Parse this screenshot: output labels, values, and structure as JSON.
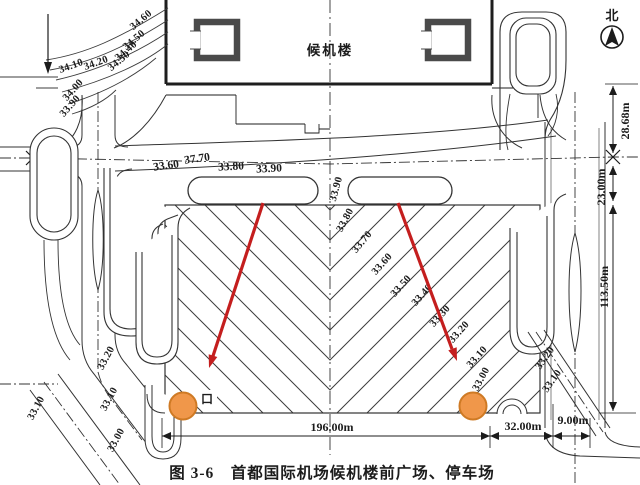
{
  "figure": {
    "caption": "图 3-6　首都国际机场候机楼前广场、停车场",
    "north_label": "北",
    "building_label": "候机楼",
    "gate_label": "口"
  },
  "colors": {
    "arrow_red": "#c41e1e",
    "circle_orange": "#f0974a",
    "circle_orange_border": "#cf7a24",
    "ink": "#1c1c1c"
  },
  "labels": {
    "topleft": [
      "34.60",
      "34.50",
      "34.40",
      "34.30",
      "34.20",
      "34.10",
      "34.00",
      "33.90"
    ],
    "roadrow": [
      "33.60",
      "37.70",
      "33.80",
      "33.90"
    ],
    "plaza": [
      "33.90",
      "33.80",
      "33.70",
      "33.60",
      "33.50",
      "33.40",
      "33.30",
      "33.20",
      "33.10",
      "33.00"
    ],
    "leftside": [
      "33.20",
      "33.10",
      "33.00",
      "33.10"
    ],
    "rightside": [
      "33.20",
      "33.10"
    ]
  },
  "dimensions": {
    "right": [
      "28.68m",
      "23.00m",
      "113.50m"
    ],
    "bottom": [
      "196.00m",
      "32.00m",
      "9.00m"
    ]
  }
}
